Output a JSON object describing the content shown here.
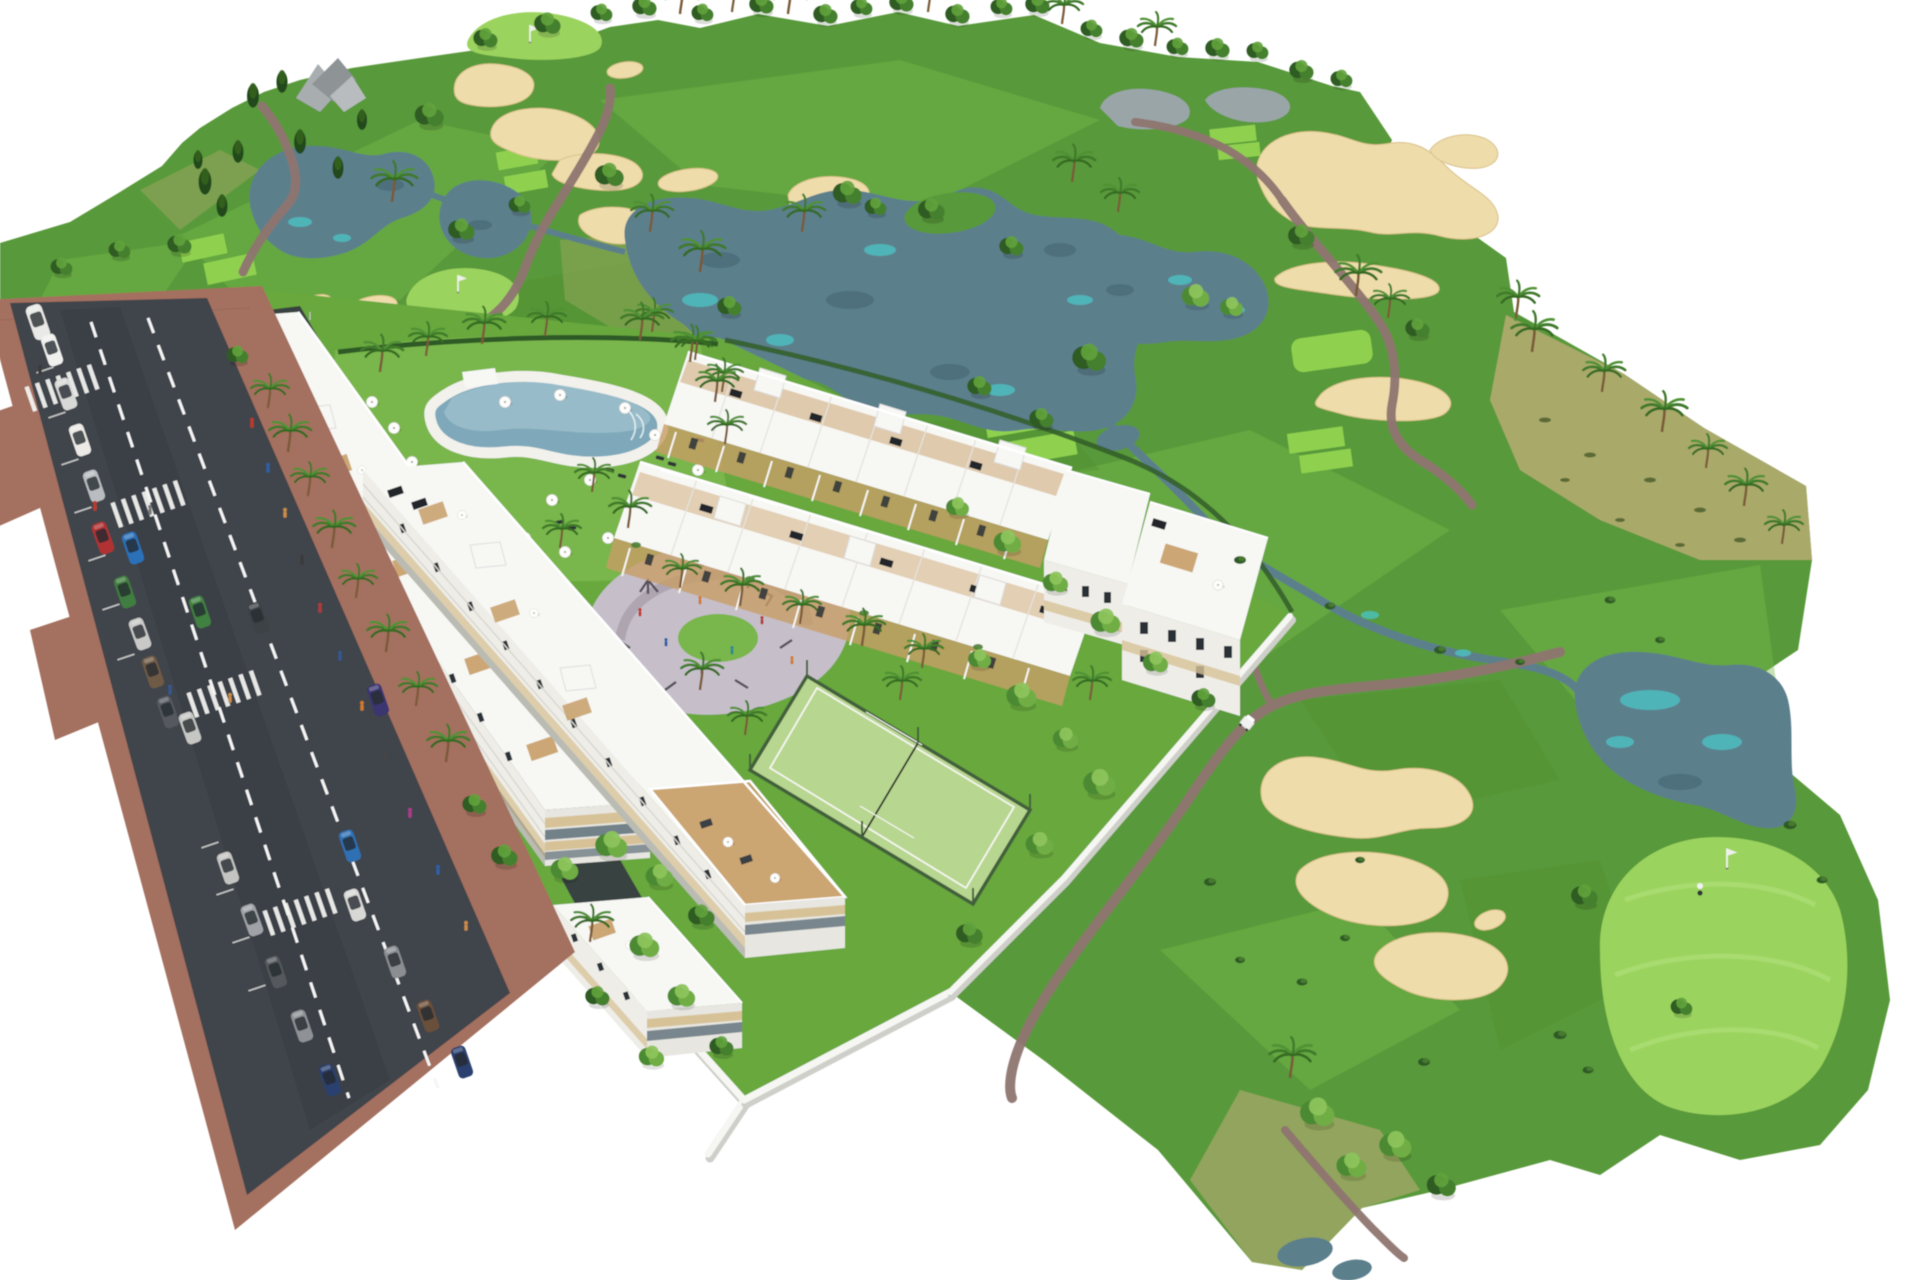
{
  "page": {
    "title": "Aerial 3D render - golf resort apartment development"
  },
  "colors": {
    "background": "#ffffff",
    "fairway": "#58993a",
    "fairwayLight": "#79bb4b",
    "fairwayDark": "#4c8c30",
    "green": "#9bd35f",
    "tee": "#8fd14f",
    "scrub": "#b2ab70",
    "sand": "#eedcab",
    "sandShade": "#d9c289",
    "lake": "#5c7f8c",
    "lakeDark": "#41606b",
    "lakeTurquoise": "#4cc4c4",
    "pond": "#9aa5a8",
    "path": "#8f7570",
    "road": "#41454c",
    "roadDark": "#35393f",
    "sidewalk": "#a4705f",
    "laneMark": "#f5f5f5",
    "wall": "#f6f6f3",
    "wallShadow": "#cfcfca",
    "building": "#f7f7f4",
    "buildingShade": "#e7e6e0",
    "facade": "#eeede7",
    "beige": "#d7c297",
    "pergola": "#c79d66",
    "window": "#2c3237",
    "glass": "#5e6e78",
    "poolWater": "#7fa9ba",
    "poolLight": "#a8c8d3",
    "deck": "#f2f1ec",
    "lawn": "#68a83e",
    "lawnLight": "#79b64b",
    "court": "#b7d690",
    "courtFence": "#42603b",
    "playground": "#c6bfc9",
    "playgroundDark": "#a89fab",
    "treeDark": "#2d5b24",
    "treeMid": "#44802e",
    "treeLight": "#61a23c",
    "palmFrond": "#3f7a2b",
    "trunk": "#7a5a38"
  },
  "scene": {
    "description": "Isometric aerial architectural rendering of a white low-rise apartment complex with lagoon pool, playground and padel court beside a golf course with lakes, sand bunkers, putting greens and palm trees; a diagonal avenue with parked cars, crosswalks and pedestrians runs along the lower left; white background outside the site.",
    "areas": [
      {
        "id": "golf-course",
        "label": "Golf course with fairways, greens, lakes and bunkers"
      },
      {
        "id": "central-lake",
        "label": "Central water hazard lake"
      },
      {
        "id": "apartment-blocks",
        "label": "Three stepped white apartment buildings with rooftop terraces"
      },
      {
        "id": "townhouse-rows",
        "label": "Two rows of white townhouses with pergola terraces"
      },
      {
        "id": "swimming-pool",
        "label": "Community lagoon pool with parasols and sun loungers"
      },
      {
        "id": "playground",
        "label": "Children's playground plaza"
      },
      {
        "id": "padel-court",
        "label": "Fenced padel tennis court"
      },
      {
        "id": "avenue",
        "label": "Avenue with parking bays, crosswalks and traffic"
      },
      {
        "id": "putting-green",
        "label": "Large putting green with flag and golfer, bottom right"
      },
      {
        "id": "cart-path",
        "label": "Golf cart path with white golf cart"
      }
    ],
    "counts": {
      "apartment_buildings": 3,
      "townhouse_rows": 2,
      "crosswalks": 4,
      "cars": 24,
      "golf_flags": 3,
      "lakes": 6,
      "sand_bunkers": 12,
      "parasols": 20,
      "padel_courts": 1
    }
  }
}
